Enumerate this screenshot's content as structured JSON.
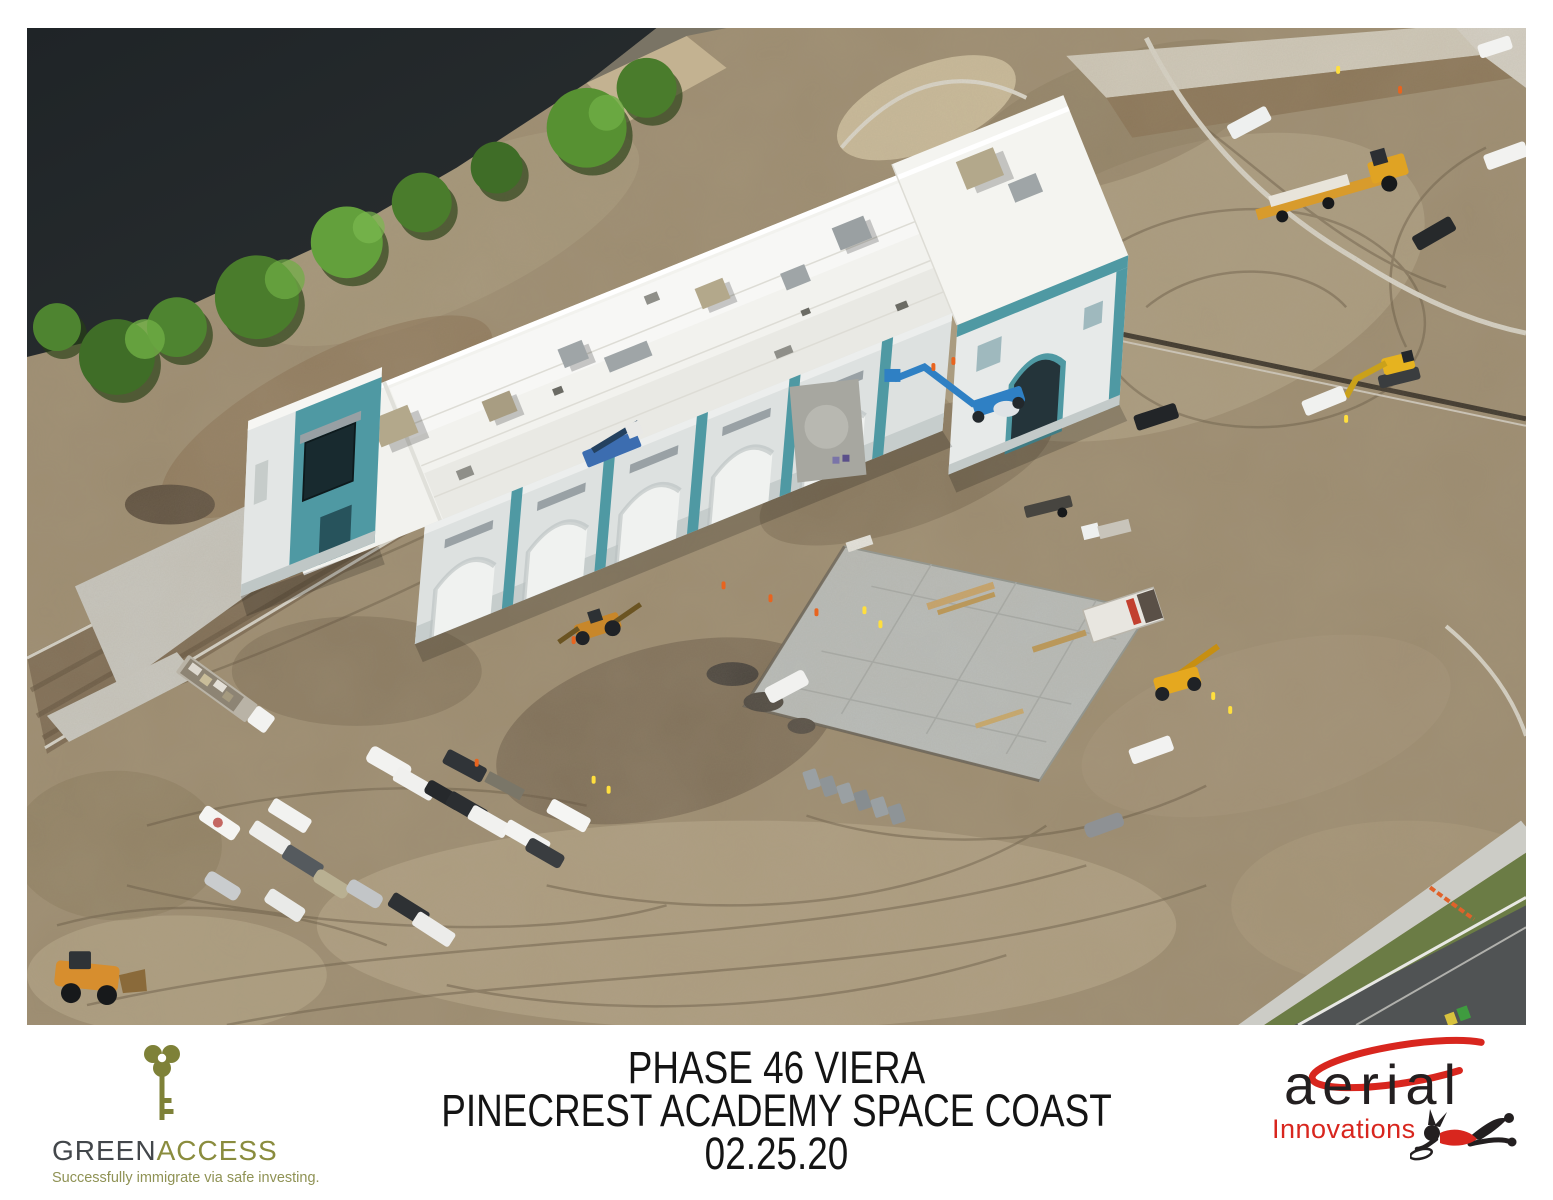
{
  "photo": {
    "alt": "Aerial view of the Pinecrest Academy Space Coast campus under construction: a long white-roofed school building with teal accents next to a dark pond lined with trees, surrounded by graded dirt, a fresh concrete slab, a shipping container, porta-potties, rows of parked cars and trucks, and heavy equipment; a finished road crosses the bottom-right corner.",
    "colors": {
      "water": "#22272b",
      "dirt": "#9c8c70",
      "roof": "#f3f3ef",
      "teal": "#4f99a3",
      "slab": "#b9bdbb",
      "grass": "#6b7c45",
      "asphalt": "#505354"
    }
  },
  "footer": {
    "greenaccess": {
      "icon": "key-icon",
      "brand_green": "GREEN",
      "brand_access": "ACCESS",
      "tagline": "Successfully immigrate via safe investing.",
      "color_text": "#43474b",
      "color_accent": "#8a8c3e"
    },
    "caption": {
      "line1": "PHASE 46 VIERA",
      "line2": "PINECREST ACADEMY SPACE COAST",
      "line3": "02.25.20"
    },
    "aerial": {
      "icon": "skydiver-icon",
      "word": "aerial",
      "sub": "Innovations",
      "color_red": "#d8261e",
      "color_black": "#231f20"
    }
  }
}
